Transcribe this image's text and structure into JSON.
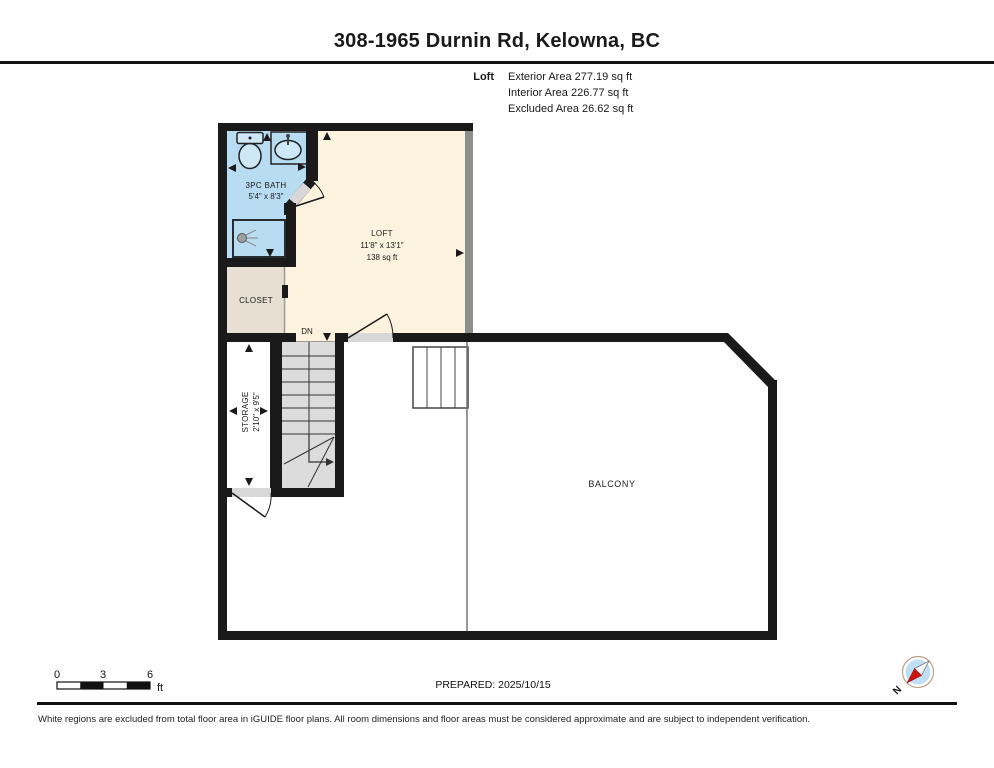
{
  "page": {
    "title": "308-1965 Durnin Rd, Kelowna, BC"
  },
  "area_summary": {
    "floor_label": "Loft",
    "lines": [
      "Exterior Area 277.19 sq ft",
      "Interior Area 226.77 sq ft",
      "Excluded Area 26.62 sq ft"
    ]
  },
  "floor_plan": {
    "rooms": {
      "bath": {
        "name": "3PC BATH",
        "dimensions": "5'4\" x 8'3\""
      },
      "loft": {
        "name": "LOFT",
        "dimensions": "11'8\" x 13'1\"",
        "area": "138 sq ft"
      },
      "closet": {
        "name": "CLOSET"
      },
      "storage": {
        "name": "STORAGE",
        "dimensions": "2'10\" x 9'5\""
      },
      "balcony": {
        "name": "BALCONY"
      },
      "stairs": {
        "direction_label": "DN"
      }
    }
  },
  "scale_bar": {
    "tick_labels": [
      "0",
      "3",
      "6"
    ],
    "unit": "ft"
  },
  "prepared_label": "PREPARED: 2025/10/15",
  "compass": {
    "north_label": "N"
  },
  "footer": {
    "disclaimer": "White regions are excluded from total floor area in iGUIDE floor plans. All room dimensions and floor areas must be considered approximate and are subject to independent verification."
  },
  "colors": {
    "wall": "#1a1a1a",
    "bath_fill": "#b8dcf2",
    "fixture_fill": "#cfe8f7",
    "loft_fill": "#fbf3dd",
    "closet_fill": "#e7dfd2",
    "stairs_fill": "#dcdcdc",
    "door_gap": "#d8d8d8",
    "compass_fill": "#bfdff5",
    "compass_needle_red": "#cc1111"
  }
}
